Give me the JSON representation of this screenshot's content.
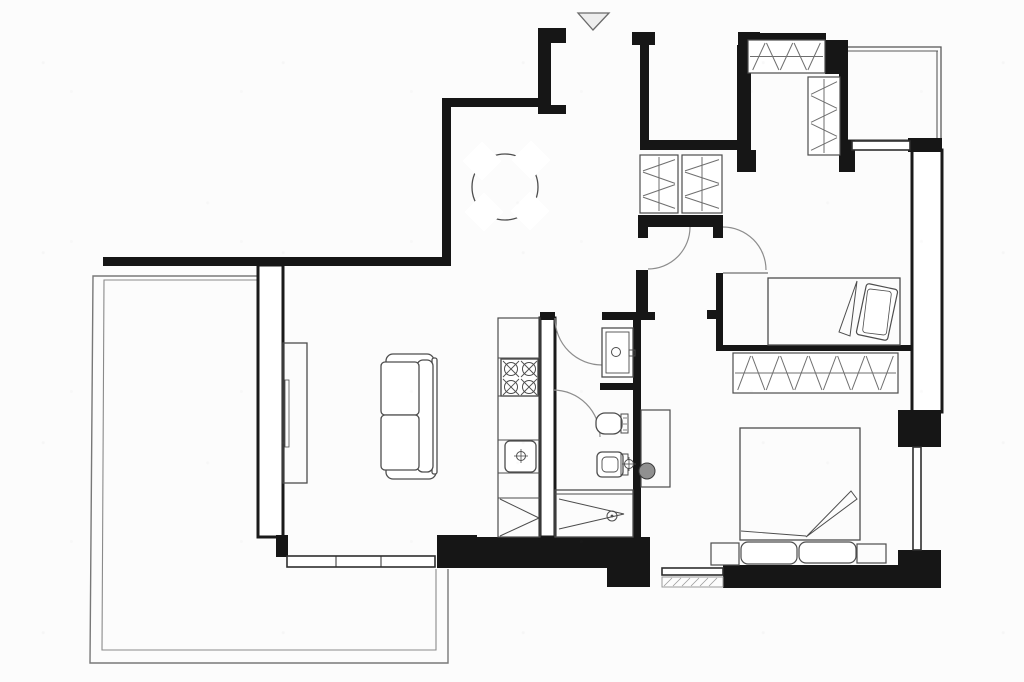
{
  "meta": {
    "description": "scanned black-and-white apartment floor plan, no text labels",
    "canvas": {
      "width": 1024,
      "height": 682
    },
    "colors": {
      "background": "#fcfcfc",
      "wall": "#161616",
      "wall_outline": "#1a1a1a",
      "window": "#2e2e2e",
      "furniture": "#4d4d4d",
      "furniture_light": "#6f6f6f",
      "door_arc": "#8d8d8d",
      "terrace": "#787878",
      "balcony": "#5a5a5a",
      "sill_hatch": "#9a9a9a",
      "marker_fill": "#ededed",
      "marker_stroke": "#6a6a6a",
      "white": "#ffffff"
    }
  },
  "plan": {
    "walls_outlined": [
      {
        "n": "living-room-west-wall",
        "x": 258,
        "y": 265,
        "w": 25,
        "h": 272
      },
      {
        "n": "kitchen-bath-wall",
        "x": 540,
        "y": 318,
        "w": 15,
        "h": 219
      },
      {
        "n": "east-exterior-wall",
        "x": 912,
        "y": 150,
        "w": 30,
        "h": 262
      }
    ],
    "walls_solid": [
      {
        "n": "living-room-north-wall",
        "x": 103,
        "y": 257,
        "w": 347,
        "h": 9
      },
      {
        "n": "dining-west-wall",
        "x": 442,
        "y": 98,
        "w": 9,
        "h": 168
      },
      {
        "n": "dining-north-wall",
        "x": 442,
        "y": 98,
        "w": 99,
        "h": 9
      },
      {
        "n": "entry-wall-flange-top",
        "x": 538,
        "y": 28,
        "w": 28,
        "h": 15
      },
      {
        "n": "entry-wall-pier",
        "x": 538,
        "y": 43,
        "w": 13,
        "h": 64
      },
      {
        "n": "entry-wall-flange-bottom",
        "x": 538,
        "y": 105,
        "w": 28,
        "h": 9
      },
      {
        "n": "stair-shaft-flange-left",
        "x": 632,
        "y": 32,
        "w": 23,
        "h": 13
      },
      {
        "n": "stair-shaft-west-wall",
        "x": 640,
        "y": 45,
        "w": 9,
        "h": 96
      },
      {
        "n": "stair-shaft-south-wall",
        "x": 640,
        "y": 140,
        "w": 103,
        "h": 10
      },
      {
        "n": "stair-shaft-flange-right",
        "x": 738,
        "y": 32,
        "w": 22,
        "h": 13
      },
      {
        "n": "bedroom1-west-wall",
        "x": 737,
        "y": 45,
        "w": 14,
        "h": 106
      },
      {
        "n": "bedroom1-west-wall-foot",
        "x": 737,
        "y": 150,
        "w": 19,
        "h": 22
      },
      {
        "n": "bedroom1-north-wall",
        "x": 756,
        "y": 33,
        "w": 70,
        "h": 8
      },
      {
        "n": "northeast-corner-block",
        "x": 825,
        "y": 40,
        "w": 23,
        "h": 34
      },
      {
        "n": "bedroom1-east-wall",
        "x": 839,
        "y": 73,
        "w": 9,
        "h": 68
      },
      {
        "n": "bedroom1-east-wall-foot",
        "x": 839,
        "y": 140,
        "w": 16,
        "h": 32
      },
      {
        "n": "balcony-south-pier",
        "x": 908,
        "y": 138,
        "w": 34,
        "h": 14
      },
      {
        "n": "hall-closet-south-wall",
        "x": 638,
        "y": 215,
        "w": 85,
        "h": 12
      },
      {
        "n": "hall-closet-foot-left",
        "x": 638,
        "y": 227,
        "w": 10,
        "h": 11
      },
      {
        "n": "hall-closet-foot-right",
        "x": 713,
        "y": 227,
        "w": 10,
        "h": 11
      },
      {
        "n": "corridor-east-stub",
        "x": 636,
        "y": 270,
        "w": 12,
        "h": 43
      },
      {
        "n": "wc-north-wall",
        "x": 602,
        "y": 312,
        "w": 53,
        "h": 8
      },
      {
        "n": "kitchen-wall-cap",
        "x": 540,
        "y": 312,
        "w": 15,
        "h": 8
      },
      {
        "n": "bath-middle-wall",
        "x": 600,
        "y": 383,
        "w": 41,
        "h": 7
      },
      {
        "n": "bath-east-wall",
        "x": 633,
        "y": 312,
        "w": 8,
        "h": 226
      },
      {
        "n": "bedroom-separation-stub",
        "x": 716,
        "y": 273,
        "w": 7,
        "h": 78
      },
      {
        "n": "bedroom-separation-tick",
        "x": 707,
        "y": 310,
        "w": 9,
        "h": 9
      },
      {
        "n": "bedroom1-south-wall",
        "x": 716,
        "y": 345,
        "w": 196,
        "h": 6
      },
      {
        "n": "south-wall-block-a",
        "x": 437,
        "y": 535,
        "w": 40,
        "h": 33
      },
      {
        "n": "kitchen-south-wall",
        "x": 477,
        "y": 537,
        "w": 173,
        "h": 31
      },
      {
        "n": "south-wall-step",
        "x": 607,
        "y": 568,
        "w": 43,
        "h": 19
      },
      {
        "n": "bedroom2-south-wall",
        "x": 723,
        "y": 565,
        "w": 175,
        "h": 23
      },
      {
        "n": "southeast-corner-block",
        "x": 898,
        "y": 550,
        "w": 43,
        "h": 38
      },
      {
        "n": "east-wall-pier",
        "x": 898,
        "y": 410,
        "w": 43,
        "h": 37
      },
      {
        "n": "living-room-wall-step",
        "x": 276,
        "y": 535,
        "w": 12,
        "h": 22
      }
    ],
    "terrace": {
      "outer": [
        [
          258,
          276
        ],
        [
          93,
          276
        ],
        [
          90,
          663
        ],
        [
          448,
          663
        ],
        [
          448,
          569
        ]
      ],
      "inner": [
        [
          258,
          280
        ],
        [
          104,
          280
        ],
        [
          102,
          650
        ],
        [
          436,
          650
        ],
        [
          436,
          569
        ]
      ]
    },
    "balcony": {
      "outline": {
        "x": 845,
        "y": 47,
        "w": 96,
        "h": 93
      },
      "double_top": [
        [
          845,
          51
        ],
        [
          938,
          51
        ]
      ],
      "double_right": [
        [
          937,
          51
        ],
        [
          937,
          140
        ]
      ]
    },
    "windows": [
      {
        "n": "living-room-window",
        "x": 287,
        "y": 556,
        "w": 148,
        "h": 11
      },
      {
        "n": "bedroom2-window",
        "x": 662,
        "y": 568,
        "w": 61,
        "h": 7
      },
      {
        "n": "balcony-window",
        "x": 852,
        "y": 141,
        "w": 58,
        "h": 9
      },
      {
        "n": "east-window",
        "x": 913,
        "y": 447,
        "w": 8,
        "h": 103
      }
    ],
    "window_ticks": [
      {
        "n": "living-window-mullion",
        "x1": 336,
        "y1": 556,
        "x2": 336,
        "y2": 567
      },
      {
        "n": "living-window-mullion",
        "x1": 381,
        "y1": 556,
        "x2": 381,
        "y2": 567
      }
    ],
    "sill": {
      "n": "bedroom2-window-sill",
      "x": 662,
      "y": 577,
      "w": 61,
      "h": 10
    },
    "doors": [
      {
        "n": "wc-door-arc",
        "cx": 602,
        "cy": 318,
        "r": 47,
        "a1": 180,
        "a2": 90,
        "sweep": 0
      },
      {
        "n": "bath-door-arc",
        "cx": 553,
        "cy": 437,
        "r": 47,
        "a1": 270,
        "a2": 0,
        "sweep": 1
      },
      {
        "n": "corridor-door-arc",
        "cx": 648,
        "cy": 227,
        "r": 42,
        "a1": 0,
        "a2": 90,
        "sweep": 1
      },
      {
        "n": "bedroom1-door-arc",
        "cx": 723,
        "cy": 270,
        "r": 43,
        "a1": 270,
        "a2": 0,
        "sweep": 1
      }
    ],
    "entrance_marker": {
      "n": "entrance-arrow",
      "pts": [
        [
          578,
          13
        ],
        [
          609,
          13
        ],
        [
          593,
          30
        ]
      ]
    },
    "wardrobes": [
      {
        "n": "bedroom1-wardrobe-top",
        "x": 748,
        "y": 40,
        "w": 77,
        "h": 33,
        "dir": "h"
      },
      {
        "n": "bedroom1-wardrobe-side",
        "x": 808,
        "y": 77,
        "w": 32,
        "h": 78,
        "dir": "v"
      },
      {
        "n": "hall-closet-left",
        "x": 640,
        "y": 155,
        "w": 38,
        "h": 58,
        "dir": "v"
      },
      {
        "n": "hall-closet-right",
        "x": 682,
        "y": 155,
        "w": 40,
        "h": 58,
        "dir": "v"
      },
      {
        "n": "bedroom2-wardrobe",
        "x": 733,
        "y": 353,
        "w": 165,
        "h": 40,
        "dir": "h"
      }
    ],
    "furniture": [
      {
        "n": "dining-table",
        "t": "circle",
        "cx": 505,
        "cy": 187,
        "r": 33,
        "f": "none"
      },
      {
        "n": "dining-chair",
        "t": "chair",
        "cx": 482,
        "cy": 161,
        "s": 28,
        "rot": 45
      },
      {
        "n": "dining-chair",
        "t": "chair",
        "cx": 531,
        "cy": 160,
        "s": 28,
        "rot": 45
      },
      {
        "n": "dining-chair",
        "t": "chair",
        "cx": 484,
        "cy": 212,
        "s": 28,
        "rot": 45
      },
      {
        "n": "dining-chair",
        "t": "chair",
        "cx": 530,
        "cy": 211,
        "s": 28,
        "rot": 45
      },
      {
        "n": "sofa-armrest",
        "t": "rect",
        "x": 386,
        "y": 354,
        "w": 48,
        "h": 15,
        "rx": 7,
        "f": "#ffffff"
      },
      {
        "n": "sofa-armrest",
        "t": "rect",
        "x": 386,
        "y": 464,
        "w": 50,
        "h": 15,
        "rx": 7,
        "f": "#ffffff"
      },
      {
        "n": "sofa-backrest",
        "t": "rect",
        "x": 432,
        "y": 358,
        "w": 5,
        "h": 116,
        "rx": 2,
        "f": "#ffffff"
      },
      {
        "n": "sofa-backrest",
        "t": "rect",
        "x": 417,
        "y": 360,
        "w": 16,
        "h": 112,
        "rx": 6,
        "f": "#ffffff"
      },
      {
        "n": "sofa-cushion",
        "t": "rect",
        "x": 381,
        "y": 362,
        "w": 38,
        "h": 53,
        "rx": 4,
        "f": "#ffffff"
      },
      {
        "n": "sofa-cushion",
        "t": "rect",
        "x": 381,
        "y": 415,
        "w": 38,
        "h": 55,
        "rx": 4,
        "f": "#ffffff"
      },
      {
        "n": "sideboard",
        "t": "rect",
        "x": 283,
        "y": 343,
        "w": 24,
        "h": 140,
        "f": "none"
      },
      {
        "n": "sideboard-inner",
        "t": "rect",
        "x": 285,
        "y": 380,
        "w": 4,
        "h": 67,
        "sw": 0.8,
        "f": "none"
      },
      {
        "n": "kitchen-counter",
        "t": "rect",
        "x": 498,
        "y": 318,
        "w": 42,
        "h": 219,
        "sw": 1.2,
        "f": "none"
      },
      {
        "n": "kitchen-shelf-line",
        "t": "line",
        "x1": 498,
        "y1": 358,
        "x2": 540,
        "y2": 358,
        "sw": 1
      },
      {
        "n": "kitchen-shelf-line",
        "t": "line",
        "x1": 498,
        "y1": 396,
        "x2": 540,
        "y2": 396,
        "sw": 1
      },
      {
        "n": "kitchen-shelf-line",
        "t": "line",
        "x1": 498,
        "y1": 440,
        "x2": 540,
        "y2": 440,
        "sw": 1
      },
      {
        "n": "kitchen-shelf-line",
        "t": "line",
        "x1": 498,
        "y1": 473,
        "x2": 540,
        "y2": 473,
        "sw": 1
      },
      {
        "n": "kitchen-shelf-line",
        "t": "line",
        "x1": 498,
        "y1": 498,
        "x2": 540,
        "y2": 498,
        "sw": 1
      },
      {
        "n": "stove",
        "t": "rect",
        "x": 501,
        "y": 359,
        "w": 37,
        "h": 37,
        "sw": 1.4,
        "f": "#ffffff"
      },
      {
        "n": "stove-burner",
        "t": "burner",
        "cx": 511,
        "cy": 369
      },
      {
        "n": "stove-burner",
        "t": "burner",
        "cx": 529,
        "cy": 369
      },
      {
        "n": "stove-burner",
        "t": "burner",
        "cx": 511,
        "cy": 387
      },
      {
        "n": "stove-burner",
        "t": "burner",
        "cx": 529,
        "cy": 387
      },
      {
        "n": "kitchen-sink",
        "t": "rect",
        "x": 505,
        "y": 441,
        "w": 31,
        "h": 31,
        "rx": 5,
        "f": "#ffffff",
        "sw": 1.3
      },
      {
        "n": "kitchen-faucet",
        "t": "faucet",
        "cx": 521,
        "cy": 456
      },
      {
        "n": "kitchen-cabinet-diagonal",
        "t": "line",
        "x1": 500,
        "y1": 499,
        "x2": 539,
        "y2": 518,
        "sw": 1
      },
      {
        "n": "kitchen-cabinet-diagonal",
        "t": "line",
        "x1": 500,
        "y1": 536,
        "x2": 539,
        "y2": 518,
        "sw": 1
      },
      {
        "n": "wc-sink",
        "t": "rect",
        "x": 602,
        "y": 328,
        "w": 31,
        "h": 49,
        "sw": 1.3,
        "f": "#ffffff"
      },
      {
        "n": "wc-sink-basin",
        "t": "rect",
        "x": 606,
        "y": 332,
        "w": 23,
        "h": 41,
        "sw": 0.9,
        "f": "none"
      },
      {
        "n": "wc-sink-drain",
        "t": "circle",
        "cx": 616,
        "cy": 352,
        "r": 4.5,
        "sw": 1,
        "f": "none"
      },
      {
        "n": "wc-sink-tap",
        "t": "rect",
        "x": 629,
        "y": 350,
        "w": 6,
        "h": 6,
        "sw": 0.9,
        "f": "none"
      },
      {
        "n": "bidet",
        "t": "rect",
        "x": 596,
        "y": 413,
        "w": 26,
        "h": 21,
        "rx": 9,
        "sw": 1.3,
        "f": "#ffffff"
      },
      {
        "n": "bidet-tank",
        "t": "rect",
        "x": 621,
        "y": 414,
        "w": 7,
        "h": 19,
        "sw": 1,
        "f": "none"
      },
      {
        "n": "bidet-tick",
        "t": "line",
        "x1": 623,
        "y1": 418,
        "x2": 627,
        "y2": 418,
        "sw": 0.7
      },
      {
        "n": "bidet-tick",
        "t": "line",
        "x1": 623,
        "y1": 424,
        "x2": 627,
        "y2": 424,
        "sw": 0.7
      },
      {
        "n": "bidet-tick",
        "t": "line",
        "x1": 623,
        "y1": 430,
        "x2": 627,
        "y2": 430,
        "sw": 0.7
      },
      {
        "n": "toilet",
        "t": "rect",
        "x": 597,
        "y": 452,
        "w": 26,
        "h": 25,
        "rx": 5,
        "sw": 1.3,
        "f": "#ffffff"
      },
      {
        "n": "toilet-bowl",
        "t": "rect",
        "x": 602,
        "y": 457,
        "w": 16,
        "h": 15,
        "rx": 4,
        "sw": 0.9,
        "f": "none"
      },
      {
        "n": "toilet-tank",
        "t": "rect",
        "x": 621,
        "y": 454,
        "w": 7,
        "h": 21,
        "sw": 1,
        "f": "none"
      },
      {
        "n": "toilet-faucet",
        "t": "faucet",
        "cx": 629,
        "cy": 464
      },
      {
        "n": "shower",
        "t": "rect",
        "x": 555,
        "y": 490,
        "w": 78,
        "h": 47,
        "sw": 1.3,
        "f": "none"
      },
      {
        "n": "shower-top-line",
        "t": "line",
        "x1": 555,
        "y1": 494,
        "x2": 633,
        "y2": 494,
        "sw": 0.9
      },
      {
        "n": "shower-zigzag",
        "t": "poly",
        "pts": [
          [
            559,
            499
          ],
          [
            624,
            514
          ],
          [
            559,
            529
          ]
        ],
        "closed": false,
        "sw": 1,
        "f": "none"
      },
      {
        "n": "shower-drain",
        "t": "circle",
        "cx": 612,
        "cy": 516,
        "r": 5,
        "sw": 1,
        "f": "none"
      },
      {
        "n": "shower-drain-dot",
        "t": "circle",
        "cx": 612,
        "cy": 516,
        "r": 1.4,
        "f": "#4d4d4d",
        "sw": 0
      },
      {
        "n": "desk",
        "t": "rect",
        "x": 641,
        "y": 410,
        "w": 29,
        "h": 77,
        "sw": 1.2,
        "f": "none"
      },
      {
        "n": "plant",
        "t": "circle",
        "cx": 647,
        "cy": 471,
        "r": 8,
        "f": "#909090",
        "s": "#3a3a3a",
        "sw": 1
      },
      {
        "n": "bed-single",
        "t": "rect",
        "x": 768,
        "y": 278,
        "w": 132,
        "h": 67,
        "sw": 1.3,
        "f": "none"
      },
      {
        "n": "bed-single-pillow",
        "t": "rotrect",
        "cx": 877,
        "cy": 312,
        "w": 32,
        "h": 52,
        "rot": 12,
        "sw": 1.2,
        "f": "#ffffff"
      },
      {
        "n": "bed-single-pillow-inner",
        "t": "rotrect",
        "cx": 877,
        "cy": 312,
        "w": 24,
        "h": 44,
        "rot": 7,
        "sw": 0.8,
        "f": "none"
      },
      {
        "n": "bed-single-blanket-fold",
        "t": "poly",
        "pts": [
          [
            857,
            281
          ],
          [
            839,
            332
          ],
          [
            850,
            336
          ]
        ],
        "closed": true,
        "sw": 1,
        "f": "none"
      },
      {
        "n": "bed-single-threshold",
        "t": "line",
        "x1": 723,
        "y1": 273,
        "x2": 768,
        "y2": 273,
        "sw": 0.9
      },
      {
        "n": "bed-double",
        "t": "rect",
        "x": 740,
        "y": 428,
        "w": 120,
        "h": 112,
        "sw": 1.3,
        "f": "none"
      },
      {
        "n": "bed-double-sheet-line",
        "t": "line",
        "x1": 741,
        "y1": 531,
        "x2": 806,
        "y2": 536,
        "sw": 0.9
      },
      {
        "n": "bed-double-blanket-fold",
        "t": "poly",
        "pts": [
          [
            806,
            537
          ],
          [
            851,
            491
          ],
          [
            857,
            499
          ]
        ],
        "closed": true,
        "sw": 1,
        "f": "none"
      },
      {
        "n": "bed-double-pillow",
        "t": "rect",
        "x": 741,
        "y": 542,
        "w": 56,
        "h": 22,
        "rx": 7,
        "sw": 1.2,
        "f": "#ffffff"
      },
      {
        "n": "bed-double-pillow",
        "t": "rect",
        "x": 799,
        "y": 542,
        "w": 57,
        "h": 21,
        "rx": 7,
        "sw": 1.2,
        "f": "#ffffff"
      },
      {
        "n": "nightstand",
        "t": "rect",
        "x": 711,
        "y": 543,
        "w": 28,
        "h": 22,
        "sw": 1.2,
        "f": "none"
      },
      {
        "n": "nightstand",
        "t": "rect",
        "x": 857,
        "y": 544,
        "w": 29,
        "h": 19,
        "sw": 1.2,
        "f": "none"
      }
    ],
    "sill_hatch_lines": [
      {
        "x1": 664,
        "y1": 586,
        "x2": 672,
        "y2": 578
      },
      {
        "x1": 673,
        "y1": 586,
        "x2": 681,
        "y2": 578
      },
      {
        "x1": 682,
        "y1": 586,
        "x2": 690,
        "y2": 578
      },
      {
        "x1": 691,
        "y1": 586,
        "x2": 699,
        "y2": 578
      },
      {
        "x1": 700,
        "y1": 586,
        "x2": 708,
        "y2": 578
      },
      {
        "x1": 709,
        "y1": 586,
        "x2": 717,
        "y2": 578
      }
    ]
  }
}
